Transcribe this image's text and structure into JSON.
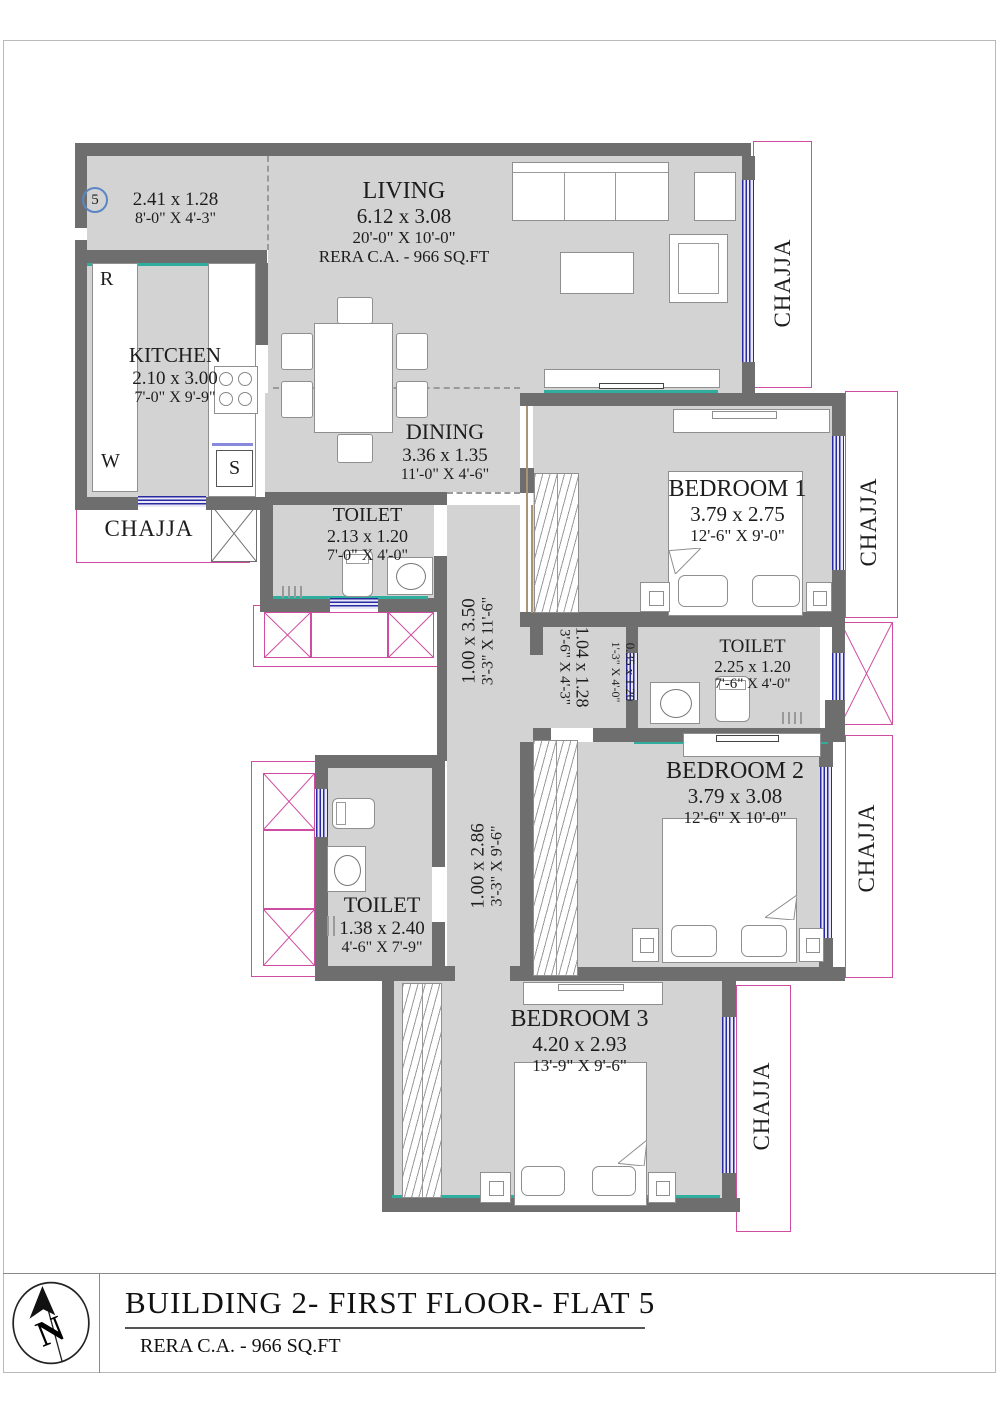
{
  "title_block": {
    "title": "BUILDING 2- FIRST FLOOR- FLAT 5",
    "subtitle": "RERA C.A. - 966 SQ.FT",
    "compass": "N"
  },
  "flat_marker": "5",
  "rooms": {
    "foyer": {
      "dim_m": "2.41 x 1.28",
      "dim_ft": "8'-0\" X 4'-3\""
    },
    "living": {
      "name": "LIVING",
      "dim_m": "6.12 x 3.08",
      "dim_ft": "20'-0\" X 10'-0\"",
      "rera": "RERA C.A. - 966 SQ.FT"
    },
    "kitchen": {
      "name": "KITCHEN",
      "dim_m": "2.10 x 3.00",
      "dim_ft": "7'-0\" X 9'-9\""
    },
    "dining": {
      "name": "DINING",
      "dim_m": "3.36 x 1.35",
      "dim_ft": "11'-0\" X 4'-6\""
    },
    "toilet_1": {
      "name": "TOILET",
      "dim_m": "2.13 x 1.20",
      "dim_ft": "7'-0\" X 4'-0\""
    },
    "bedroom_1": {
      "name": "BEDROOM 1",
      "dim_m": "3.79 x 2.75",
      "dim_ft": "12'-6\" X 9'-0\""
    },
    "toilet_2": {
      "name": "TOILET",
      "dim_m": "2.25 x 1.20",
      "dim_ft": "7'-6\" X 4'-0\""
    },
    "bedroom_2": {
      "name": "BEDROOM 2",
      "dim_m": "3.79 x 3.08",
      "dim_ft": "12'-6\" X 10'-0\""
    },
    "toilet_3": {
      "name": "TOILET",
      "dim_m": "1.38 x 2.40",
      "dim_ft": "4'-6\" X 7'-9\""
    },
    "bedroom_3": {
      "name": "BEDROOM 3",
      "dim_m": "4.20 x 2.93",
      "dim_ft": "13'-9\" X 9'-6\""
    },
    "passage_1": {
      "dim_m": "1.00 x 3.50",
      "dim_ft": "3'-3\" X 11'-6\""
    },
    "lobby": {
      "dim_m": "1.04 x 1.28",
      "dim_ft": "3'-6\" X 4'-3\""
    },
    "niche": {
      "dim_m": "0.35 x 1.20",
      "dim_ft": "1'-3\" X 4'-0\""
    },
    "passage_2": {
      "dim_m": "1.00 x 2.86",
      "dim_ft": "3'-3\" X 9'-6\""
    }
  },
  "balconies": {
    "label": "CHAJJA"
  },
  "kitchen_fixtures": {
    "refrigerator": "R",
    "wash_area": "W",
    "sink": "S"
  },
  "colors": {
    "wall": "#6e6e6e",
    "floor": "#d3d3d3",
    "chajja_outline": "#cf4da0",
    "window": "#2a2aa0",
    "accent_teal": "#2fae9e",
    "compass_blue": "#5b86c4"
  }
}
